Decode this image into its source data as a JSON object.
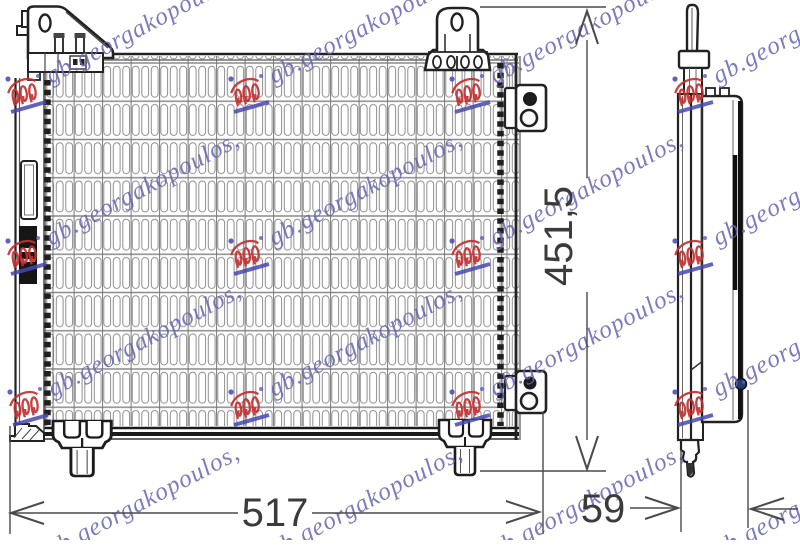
{
  "drawing": {
    "subject": "condenser-technical-drawing",
    "dimensions": {
      "width_label": "517",
      "depth_label": "59",
      "height_label": "451,5"
    },
    "watermark": {
      "text": "gb.georgakopoulos,",
      "text_color": "#6565b2",
      "stamp_color": "#c53030"
    },
    "line_color": "#222222",
    "mesh_color": "#8f8f8f"
  }
}
